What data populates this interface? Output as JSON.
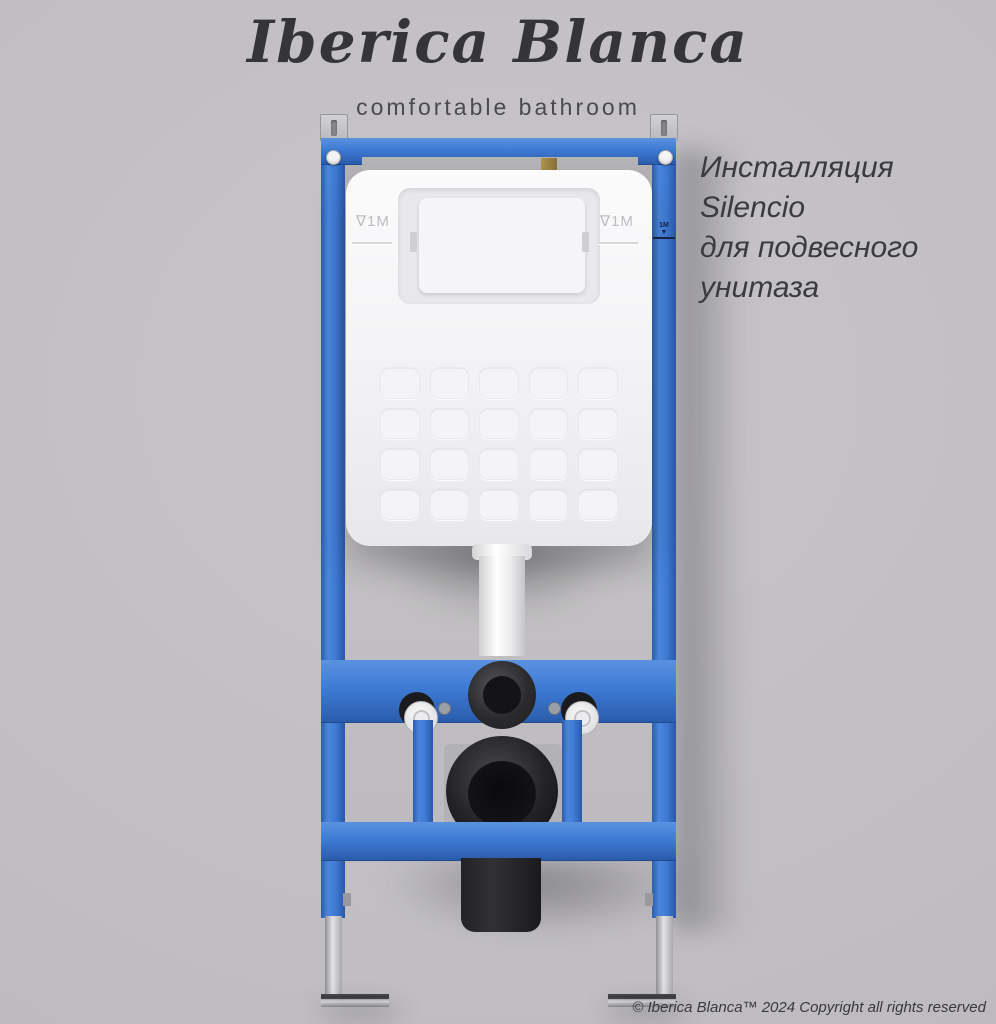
{
  "brand": {
    "logo": "Iberica Blanca",
    "tagline": "comfortable bathroom"
  },
  "product_title": {
    "lines": [
      "Инсталляция",
      "Silencio",
      "для подвесного",
      "унитаза"
    ]
  },
  "footer": {
    "copyright": "© Iberica Blanca™ 2024 Copyright all rights reserved"
  },
  "markings": {
    "cistern_left": "∇1M",
    "cistern_right": "∇1M",
    "rail_mark": "1M",
    "rail_mark_arrow": "▼"
  },
  "colors": {
    "frame_blue": "#3c79d3",
    "background": "#c0bec1",
    "cistern_white": "#f4f4f6",
    "pipe_black": "#1c1c1f"
  }
}
